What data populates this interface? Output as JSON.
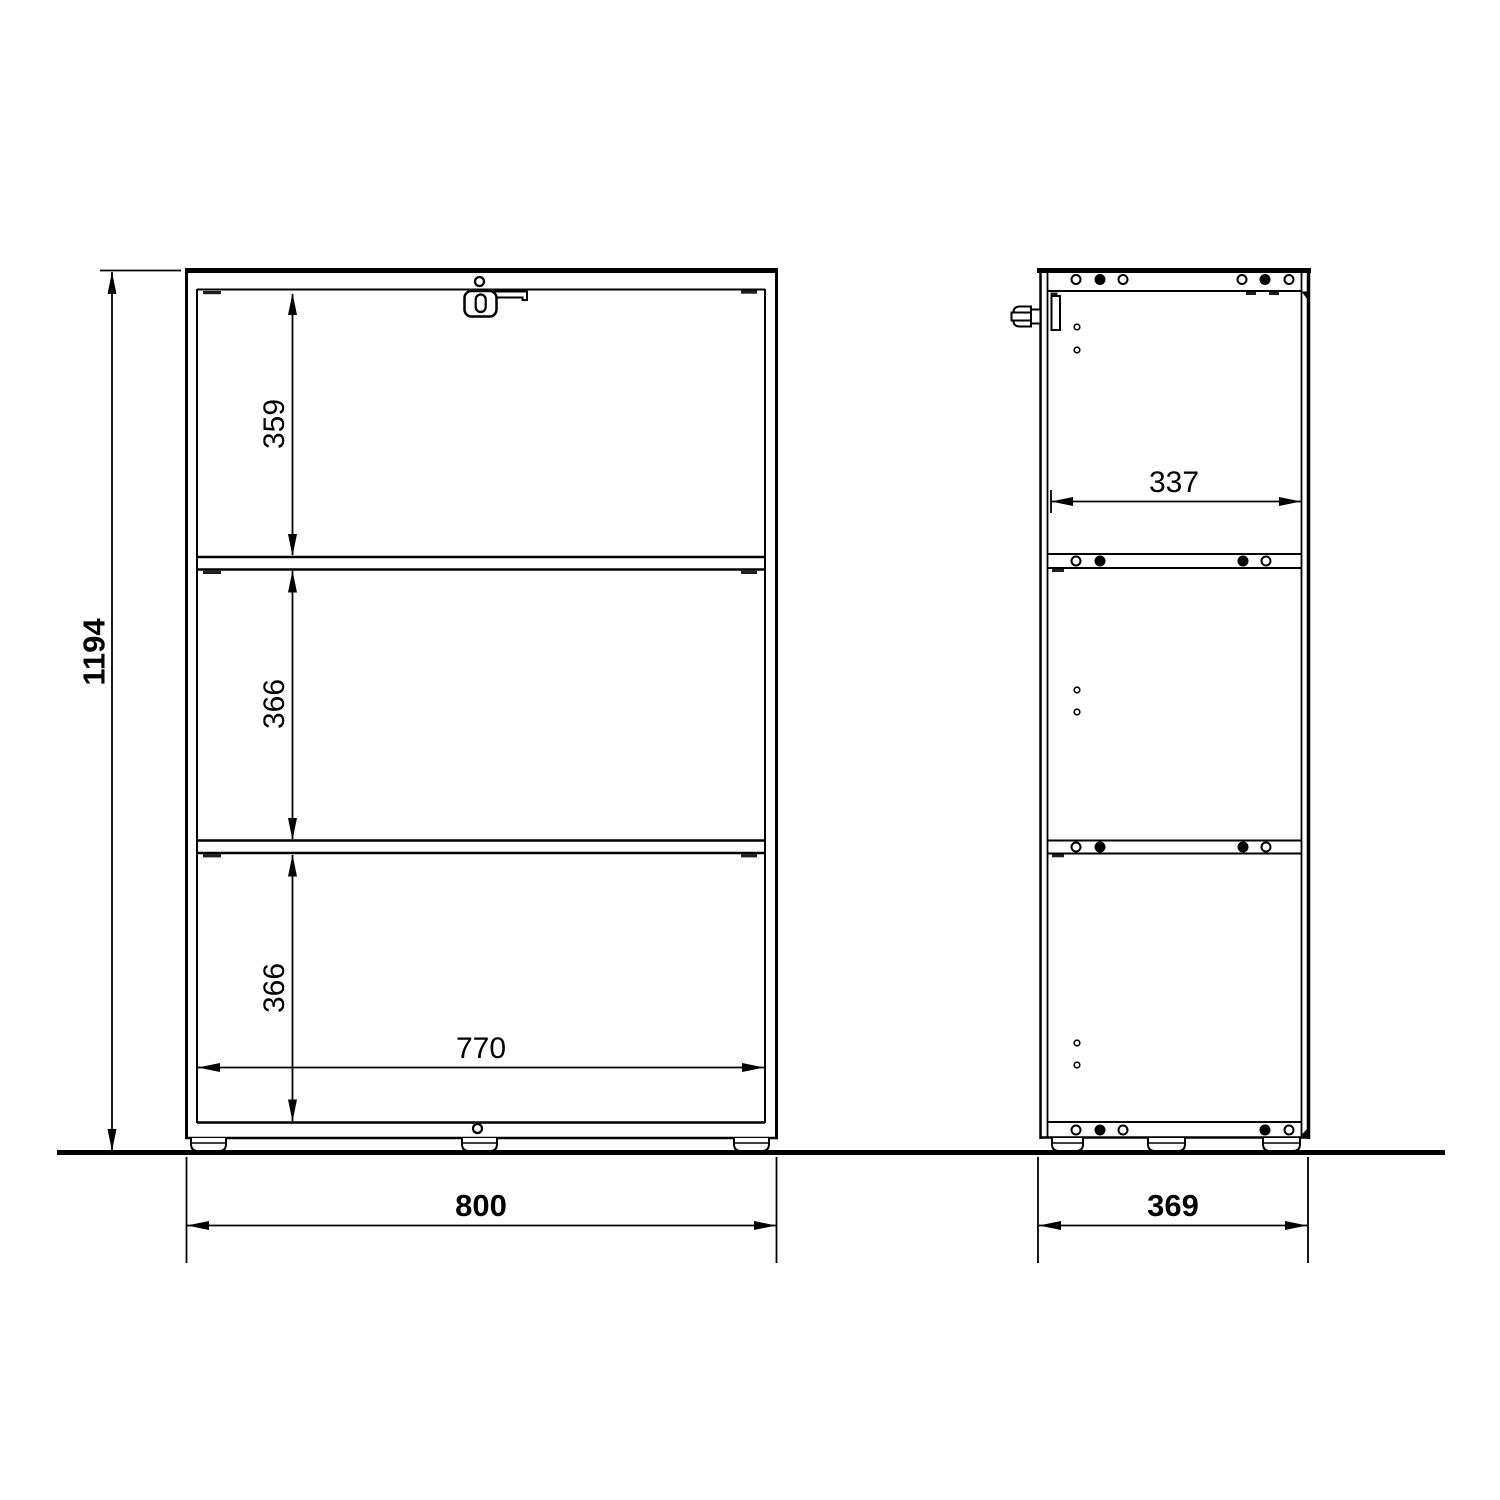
{
  "colors": {
    "background": "#ffffff",
    "line": "#000000"
  },
  "front_view": {
    "overall_height": "1194",
    "top_compartment_height": "359",
    "middle_compartment_height": "366",
    "bottom_compartment_height": "366",
    "inner_width": "770",
    "overall_width": "800"
  },
  "side_view": {
    "inner_depth": "337",
    "overall_depth": "369"
  }
}
